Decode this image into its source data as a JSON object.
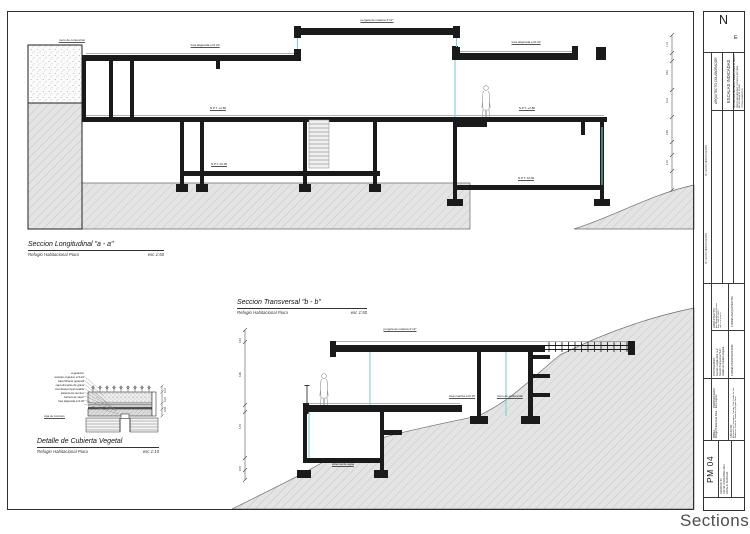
{
  "sheet": {
    "caption": "Sections"
  },
  "drawings": {
    "longitudinal": {
      "title": "Seccion  Longitudinal \"a - a\"",
      "subtitle": "Refugio Habitacional Piura",
      "scale": "esc 1:50"
    },
    "transversal": {
      "title": "Seccion  Transversal \"b - b\"",
      "subtitle": "Refugio Habitacional Piura",
      "scale": "esc 1:50"
    },
    "detail": {
      "title": "Detalle de Cubierta Vegetal",
      "subtitle": "Refugio Habitacional Piura",
      "scale": "esc 1:10"
    }
  },
  "annotations": {
    "d1": [
      "muro de contención",
      "losa aligerada e=0.20",
      "pergola de madera 2\"x2\"",
      "losa aligerada e=0.20",
      "N.P.T. +2.80",
      "N.P.T. +2.80",
      "N.P.T. ±0.00",
      "N.P.T. ±0.00"
    ],
    "d2": [
      "pergola de madera 2\"x2\"",
      "losa maciza e=0.15",
      "muro de contención",
      "cisterna de agua"
    ],
    "d3_layers": [
      "vegetacion",
      "sustrato organico e=0.10",
      "capa filtrante geotextil",
      "capa drenante de grava",
      "membrana impermeable",
      "aislamiento termico",
      "barrera de vapor",
      "losa aligerada e=0.20"
    ],
    "d3_extra": "viga de concreto"
  },
  "dims": {
    "d1": [
      "1.15",
      "0.40",
      "3.10",
      "2.80",
      "2.15"
    ],
    "d2": [
      "0.40",
      "3.06",
      "4.70",
      "0.70"
    ],
    "d3": [
      "0.10",
      "0.15",
      "0.30"
    ]
  },
  "titleblock": {
    "north": "N",
    "east": "E",
    "collaborator": "ARQUITECTO COLABORADOR",
    "scales": "ESCALAS INDICADAS",
    "notes": [
      "LAS MEDIDAS INDICADAS PRIMAN SOBRE EL DIBUJO",
      "VERIFICAR MEDIDAS Y NIVELES EN OBRA",
      "NO ESCALAR EL PLANO",
      "COTAS EN METROS"
    ],
    "revision_header_1": "Nº   FECHA   MODIFICACIÓN",
    "revision_header_2": "Nº   FECHA   MODIFICACIÓN",
    "firma_arquitecto": "FIRMA ARQUITECTO:",
    "firma_propietario": "FIRMA PROPIETARIO:",
    "arquitecto_label": "ARQUITECTO:",
    "arquitecto_lines": [
      "Arq. Maria Mazzali Herrera",
      "Reg. CAP Nº 10457",
      "Telf. 073 345678"
    ],
    "contenido_label": "CONTENIDO:",
    "contenido_lines": [
      "Seccion Longitudinal \"a-a\"",
      "Seccion Transversal \"b-b\"",
      "Detalle de Cubierta Vegetal"
    ],
    "propietario_label": "PROPIETARIO:",
    "propietario_line": "Erica Laplout",
    "obra_label": "OBRA:",
    "obra_line": "Refugio Habitacional Piura",
    "ubicacion_label": "UBICACIÓN:",
    "ubicacion_lines": [
      "Malecon Las Casuarinas, Country Club, Sector La Isla",
      "Distrito de Sechura, Provincia y Region Piura"
    ],
    "sheet_number": "PM 04",
    "meta_lines": [
      "REVISION: 04",
      "FECHA: NOVIEMBRE 2012",
      "ESCALA: INDICADA"
    ]
  }
}
